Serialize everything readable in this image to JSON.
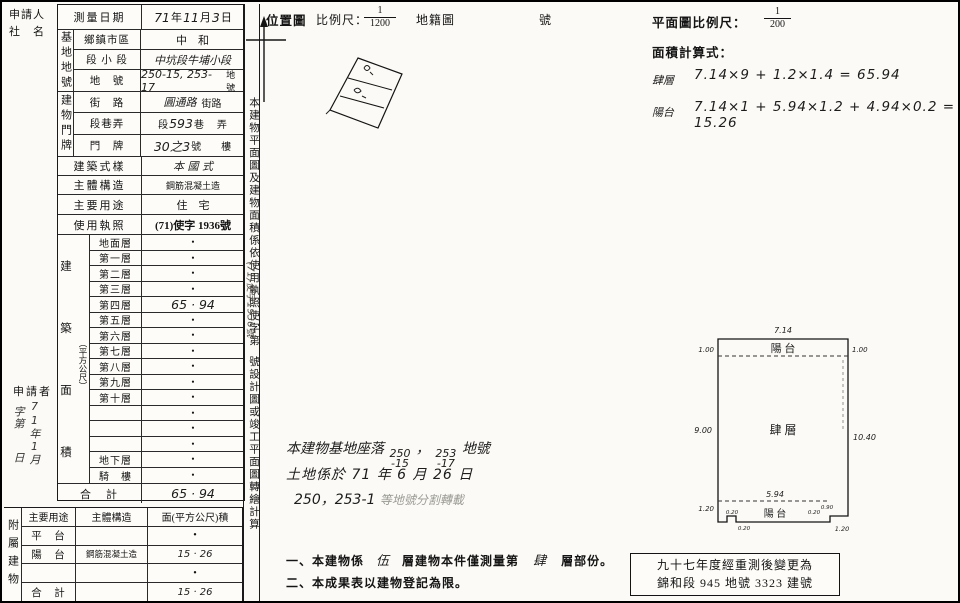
{
  "left_margin": {
    "applicant_label": "申請人",
    "name_label": "社　名",
    "applicant2": "申請者",
    "stamp": {
      "col1": "71年1月",
      "col2": "字第",
      "col3": "日"
    }
  },
  "main_table": {
    "survey_date": {
      "label": "測量日期",
      "parts": [
        "71",
        "年",
        "11",
        "月",
        "3",
        "日"
      ]
    },
    "site_group": {
      "chars": "基地地號",
      "rows": [
        {
          "label": "鄉鎮市區",
          "value": "中　和"
        },
        {
          "label": "段 小 段",
          "value": "中坑段牛埔小段"
        },
        {
          "label": "地　號",
          "value": "250-15, 253-17",
          "suffix": "地號"
        }
      ]
    },
    "door_group": {
      "chars": "建物門牌",
      "rows": [
        {
          "label": "街　路",
          "value": "圓通路",
          "suffix": "街路"
        },
        {
          "label": "段巷弄",
          "pre": "段",
          "value": "593",
          "mid": "巷",
          "suffix": "弄"
        },
        {
          "label": "門　牌",
          "value": "30之3",
          "suffix": "號　　樓"
        }
      ]
    },
    "style_row": {
      "label": "建築式樣",
      "value": "本 國 式"
    },
    "structure_row": {
      "label": "主體構造",
      "value": "鋼筋混凝土造"
    },
    "usage_row": {
      "label": "主要用途",
      "value": "住　宅"
    },
    "license_row": {
      "label": "使用執照",
      "value": "(71)使字 1936號"
    },
    "area_group": {
      "chars": [
        "建",
        "築",
        "面",
        "積"
      ],
      "unit": "（平方公尺）",
      "floors": [
        {
          "label": "地面層",
          "value": "•"
        },
        {
          "label": "第一層",
          "value": "•"
        },
        {
          "label": "第二層",
          "value": "•"
        },
        {
          "label": "第三層",
          "value": "•"
        },
        {
          "label": "第四層",
          "value": "65 · 94"
        },
        {
          "label": "第五層",
          "value": "•"
        },
        {
          "label": "第六層",
          "value": "•"
        },
        {
          "label": "第七層",
          "value": "•"
        },
        {
          "label": "第八層",
          "value": "•"
        },
        {
          "label": "第九層",
          "value": "•"
        },
        {
          "label": "第十層",
          "value": "•"
        },
        {
          "label": "",
          "value": "•"
        },
        {
          "label": "",
          "value": "•"
        },
        {
          "label": "",
          "value": "•"
        },
        {
          "label": "地下層",
          "value": "•"
        },
        {
          "label": "騎　樓",
          "value": "•"
        }
      ],
      "total": {
        "label": "合　計",
        "value": "65 · 94"
      }
    }
  },
  "attached_table": {
    "side": "附屬建物",
    "headers": [
      "主要用途",
      "主體構造",
      "面(平方公尺)積"
    ],
    "rows": [
      {
        "use": "平　台",
        "structure": "",
        "area": "•"
      },
      {
        "use": "陽　台",
        "structure": "鋼筋混凝土造",
        "area": "15 · 26"
      },
      {
        "use": "",
        "structure": "",
        "area": "•"
      },
      {
        "use": "合　計",
        "structure": "",
        "area": "15 · 26"
      }
    ]
  },
  "strip": {
    "part1": "本建物平面圖及建物面積係依使用執照",
    "license_label": "使字第",
    "stamp": "(71)使字1936號",
    "part2": "號設計圖或竣工平面圖轉繪計算"
  },
  "location_map": {
    "title": "位置圖",
    "scale_label": "比例尺：",
    "num": "1",
    "den": "1200",
    "map_label": "地籍圖",
    "suffix": "號"
  },
  "plan_calc": {
    "scale_label": "平面圖比例尺：",
    "num": "1",
    "den": "200",
    "calc_title": "面積計算式：",
    "f1": {
      "name": "肆層",
      "expr": "7.14×9 + 1.2×1.4 = 65.94"
    },
    "f2": {
      "name": "陽台",
      "expr": "7.14×1 + 5.94×1.2 + 4.94×0.2 = 15.26"
    }
  },
  "land_note": {
    "l1_pre": "本建物基地座落",
    "l1_n1_top": "250",
    "l1_n1_bot": "-15",
    "l1_comma": "，",
    "l1_n2_top": "253",
    "l1_n2_bot": "-17",
    "l1_suf": "地號",
    "l2": "土地係於 71 年 6 月 26 日",
    "l3_hand": "250，253-1",
    "l3_faint": "等地號分割轉載"
  },
  "notes": {
    "n1_pre": "一、本建物係",
    "n1_h1": "伍",
    "n1_mid": "層建物本件僅測量第",
    "n1_h2": "肆",
    "n1_suf": "層部份。",
    "n2": "二、本成果表以建物登記為限。"
  },
  "remeasure_box": {
    "line1": "九十七年度經重測後變更為",
    "line2": "錦和段 945 地號 3323 建號"
  },
  "floor_plan": {
    "dim_top": "7.14",
    "dim_top_left": "1.00",
    "dim_top_right": "1.00",
    "dim_left": "9.00",
    "dim_right": "10.40",
    "dim_bottom_left": "1.20",
    "dim_bottom_width": "5.94",
    "dim_step": "1.20",
    "s1": "0.20",
    "s2": "0.20",
    "s3": "0.20",
    "s4": "0.90",
    "balcony_top": "陽 台",
    "floor_label": "肆 層",
    "balcony_bottom": "陽 台"
  }
}
